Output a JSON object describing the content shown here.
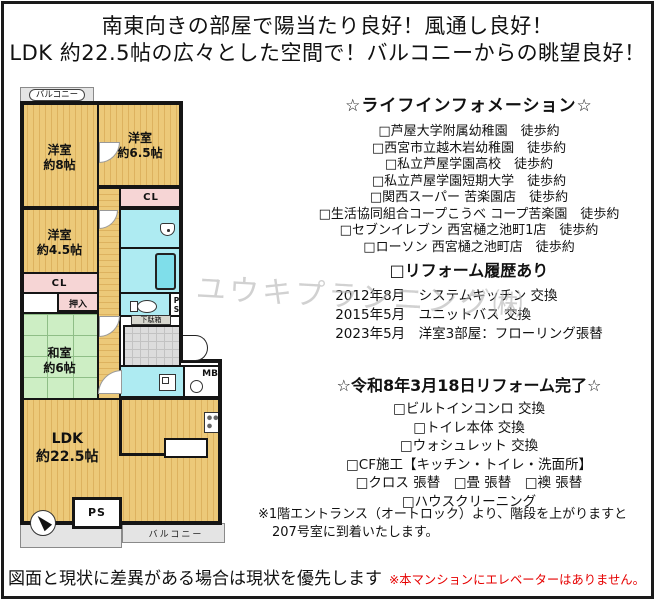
{
  "header": {
    "line1": "南東向きの部屋で陽当たり良好！風通し良好！",
    "line2": "LDK 約22.5帖の広々とした空間で！バルコニーからの眺望良好！"
  },
  "floorplan": {
    "balcony_top_label": "バルコニー",
    "balcony_bottom_label": "バルコニー",
    "rooms": {
      "yoshitsu8": {
        "name": "洋室",
        "size": "約8帖"
      },
      "yoshitsu65": {
        "name": "洋室",
        "size": "約6.5帖"
      },
      "yoshitsu45": {
        "name": "洋室",
        "size": "約4.5帖"
      },
      "washitsu": {
        "name": "和室",
        "size": "約6帖"
      },
      "ldk": {
        "name": "LDK",
        "size": "約22.5帖"
      }
    },
    "labels": {
      "cl1": "CL",
      "cl2": "CL",
      "oshiire": "押入",
      "getabako": "下駄箱",
      "mb": "MB",
      "ps_small": "PS",
      "ps_bottom": "PS"
    }
  },
  "life_info": {
    "heading": "☆ライフインフォメーション☆",
    "items": [
      "□芦屋大学附属幼稚園　徒歩約",
      "□西宮市立越木岩幼稚園　徒歩約",
      "□私立芦屋学園高校　徒歩約",
      "□私立芦屋学園短期大学　徒歩約",
      "□関西スーパー 苦楽園店　徒歩約",
      "□生活協同組合コープこうべ コープ苦楽園　徒歩約",
      "□セブンイレブン 西宮樋之池町1店　徒歩約",
      "□ローソン 西宮樋之池町店　徒歩約"
    ]
  },
  "reform_history": {
    "heading": "□リフォーム履歴あり",
    "items": [
      "2012年8月　システムキッチン 交換",
      "2015年5月　ユニットバス 交換",
      "2023年5月　洋室3部屋：フローリング張替"
    ]
  },
  "reform_done": {
    "heading": "☆令和8年3月18日リフォーム完了☆",
    "items": [
      "□ビルトインコンロ 交換",
      "□トイレ本体 交換",
      "□ウォシュレット 交換",
      "□CF施工【キッチン・トイレ・洗面所】",
      "□クロス 張替　□畳 張替　□襖 張替",
      "□ハウスクリーニング"
    ]
  },
  "note": {
    "line1": "※1階エントランス（オートロック）より、階段を上がりますと",
    "line2": "207号室に到着いたします。"
  },
  "footer": {
    "disclaimer": "図面と現状に差異がある場合は現状を優先します",
    "warning": "※本マンションにエレベーターはありません。"
  },
  "watermark": "ユウキプランニング㈱",
  "colors": {
    "wall": "#151515",
    "wood_floor": "#ecc979",
    "wood_stripe": "#ddb25f",
    "tatami": "#cdeec4",
    "tatami_line": "#8fbe87",
    "closet_pink": "#f6d5d5",
    "wet_blue": "#aeebf2",
    "tub_blue": "#7fdeea",
    "balcony_gray": "#e4e4e4",
    "tile_gray": "#dcdcdc",
    "warning_red": "#e60000",
    "watermark_gray": "#b5b5b5"
  }
}
